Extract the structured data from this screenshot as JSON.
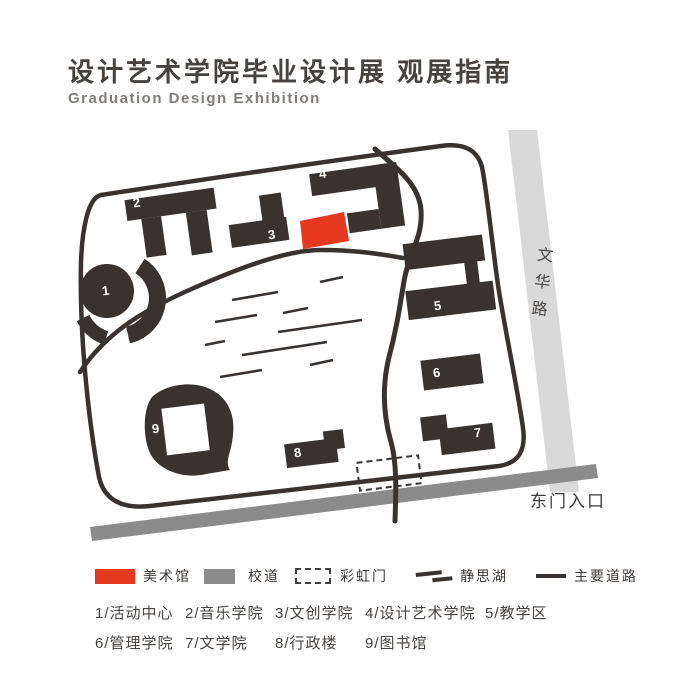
{
  "header": {
    "title": "设计艺术学院毕业设计展 观展指南",
    "subtitle": "Graduation Design Exhibition"
  },
  "map": {
    "numbers": [
      "1",
      "2",
      "3",
      "4",
      "5",
      "6",
      "7",
      "8",
      "9"
    ],
    "wenhua_road_label": "文华路",
    "east_gate_label": "东门入口"
  },
  "legend": {
    "art_museum": "美术馆",
    "campus_road": "校道",
    "rainbow_gate": "彩虹门",
    "jingsi_lake": "静思湖",
    "main_road": "主要道路"
  },
  "building_index": {
    "row1": [
      "1/活动中心",
      "2/音乐学院",
      "3/文创学院",
      "4/设计艺术学院",
      "5/教学区"
    ],
    "row2": [
      "6/管理学院",
      "7/文学院",
      "8/行政楼",
      "9/图书馆"
    ]
  },
  "colors": {
    "accent_red": "#e5391f",
    "building_dark": "#383330",
    "road_light": "#d9d9d9",
    "road_mid": "#8b8b8b"
  }
}
